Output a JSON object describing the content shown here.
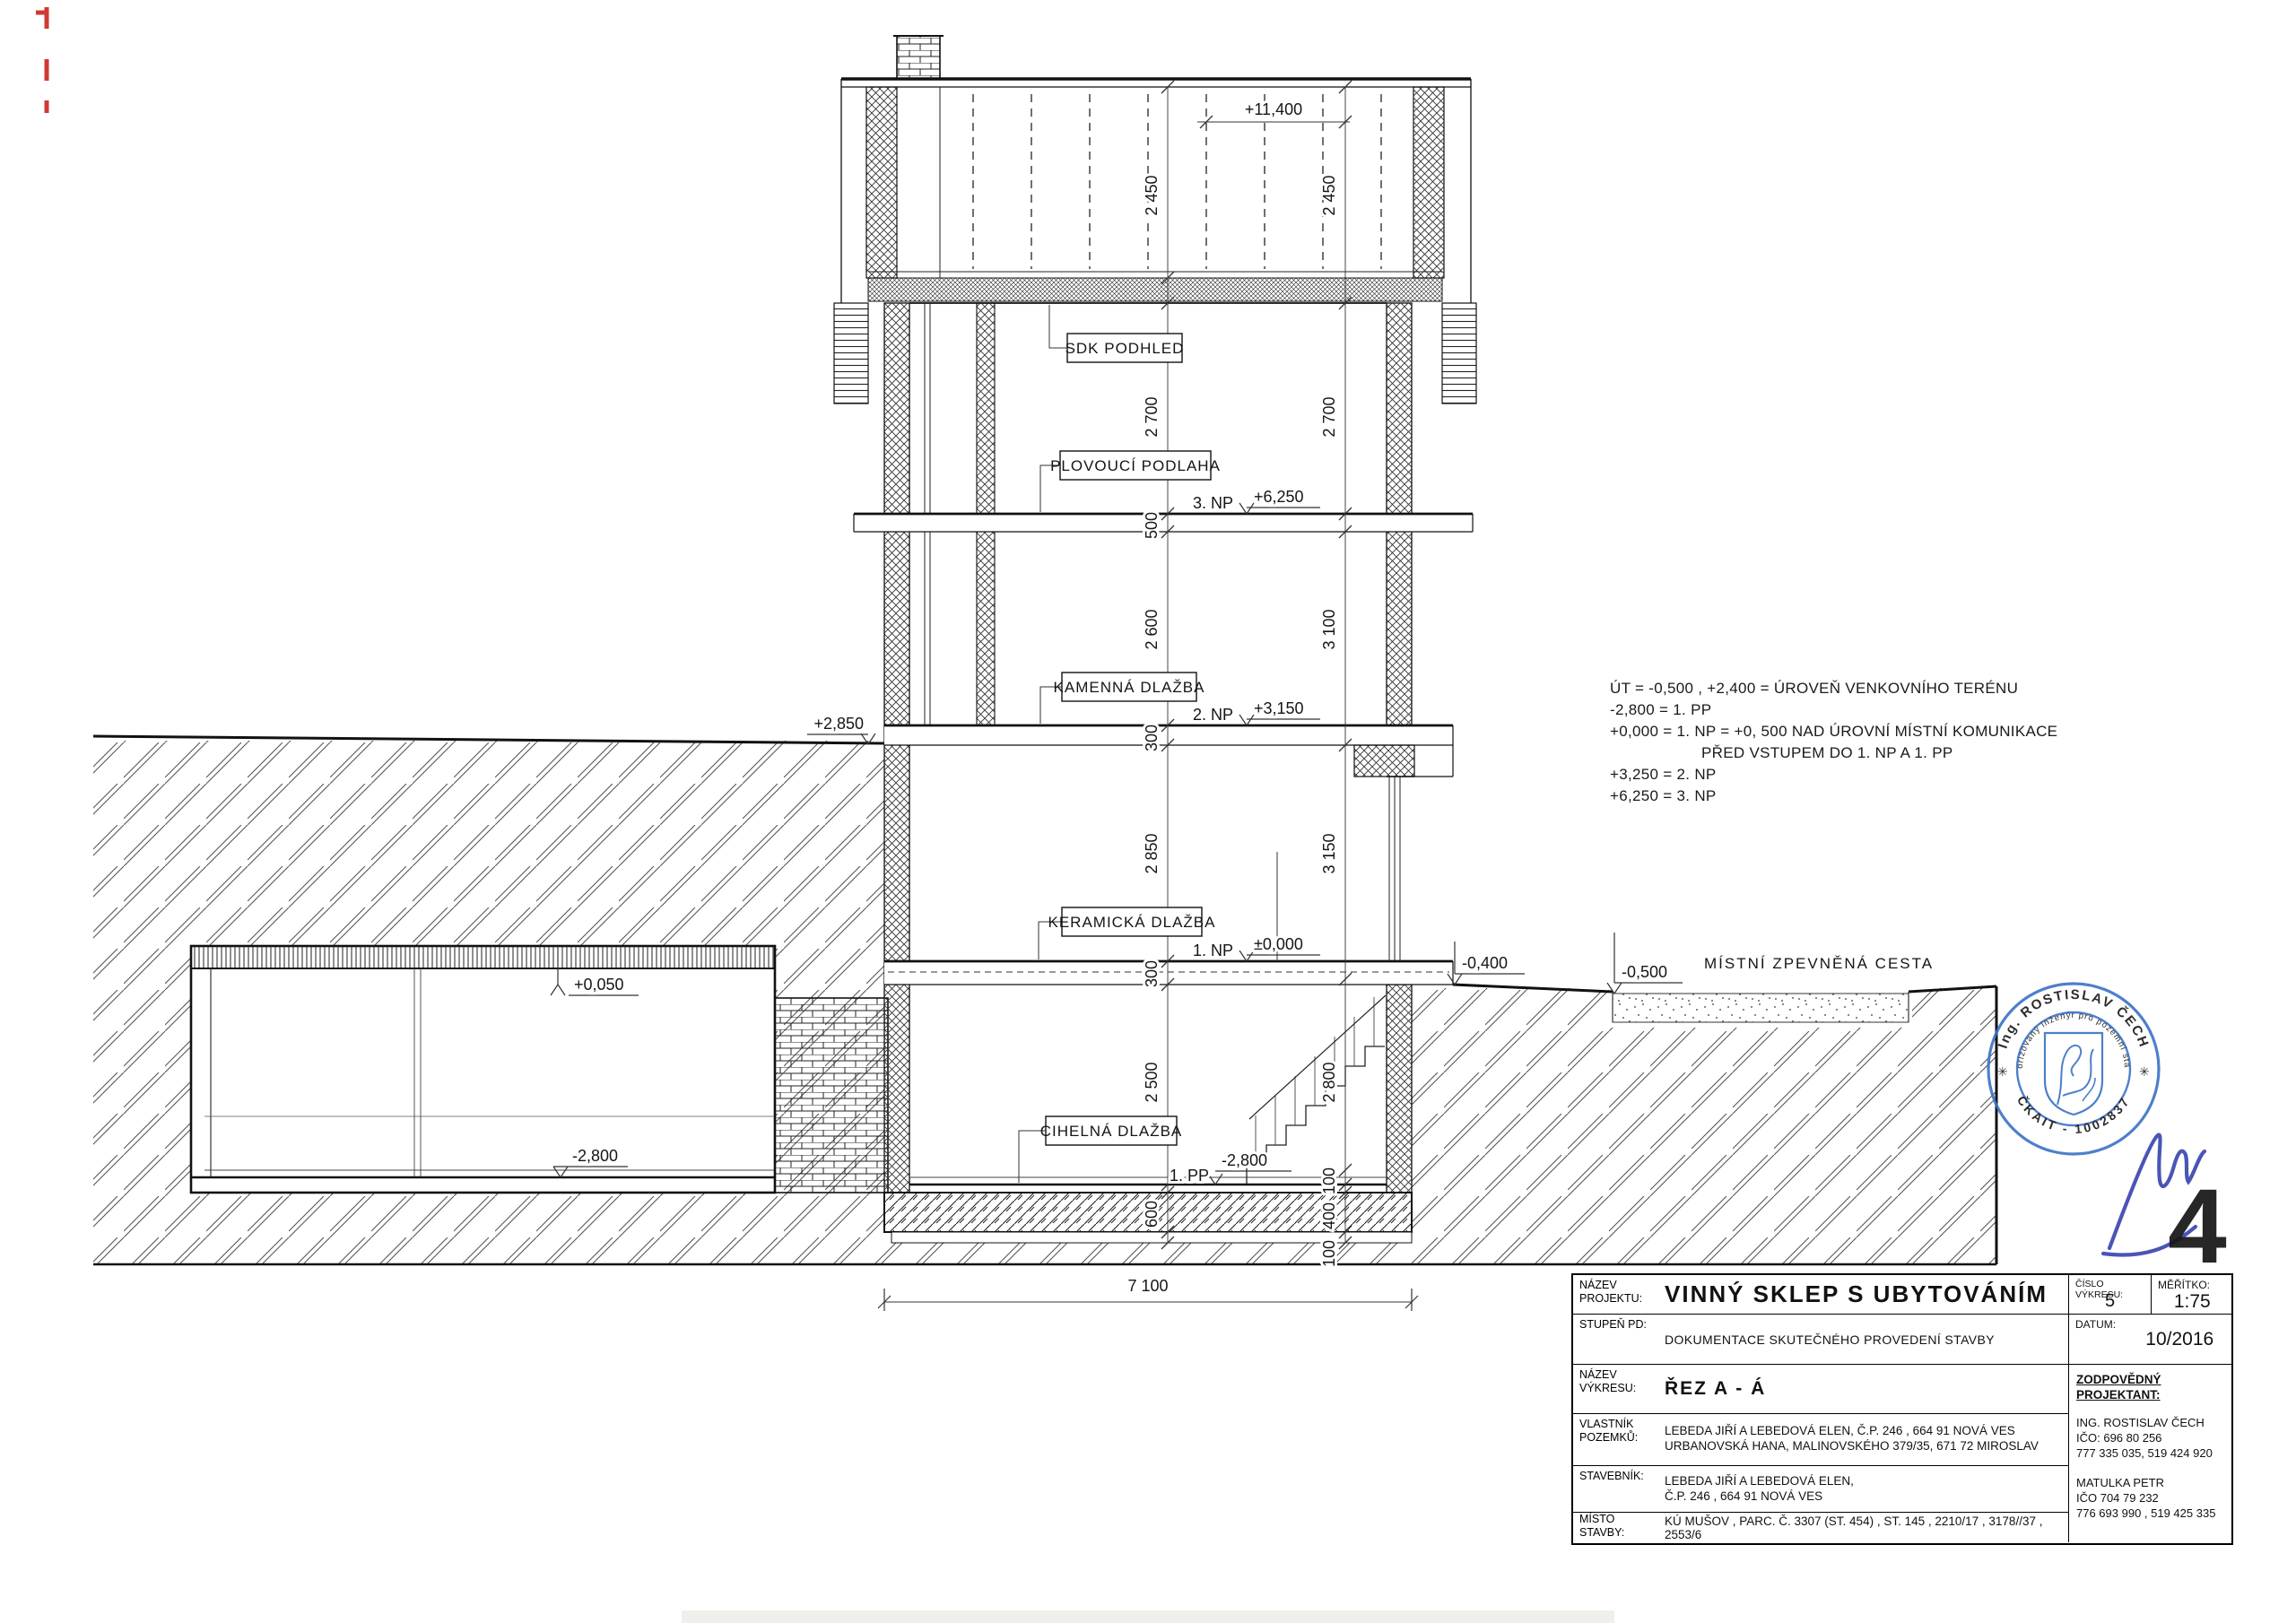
{
  "dims": {
    "top": "+11,400",
    "attic_left": "2 450",
    "attic_right": "2 450",
    "f3_left": "2 700",
    "f3_right": "2 700",
    "slab3": "500",
    "f2_left": "2 600",
    "f2_right": "3 100",
    "slab2": "300",
    "f1_left": "2 850",
    "f1_right": "3 150",
    "slab1": "300",
    "pp_left": "2 500",
    "pp_right": "2 800",
    "pp_floor": "100",
    "base": "600",
    "base_right": "400",
    "lean": "100",
    "width": "7 100"
  },
  "levels": {
    "np3": "+6,250",
    "np3_tag": "3. NP",
    "np2": "+3,150",
    "np2_tag": "2. NP",
    "np1": "±0,000",
    "np1_tag": "1. NP",
    "pp1": "-2,800",
    "pp1_tag": "1. PP",
    "terrain_left": "+2,850",
    "cellar_top": "+0,050",
    "cellar_floor": "-2,800",
    "ext_near": "-0,400",
    "ext_road": "-0,500"
  },
  "materials": {
    "ceiling3": "SDK PODHLED",
    "floor3": "PLOVOUCÍ PODLAHA",
    "floor2": "KAMENNÁ DLAŽBA",
    "floor1": "KERAMICKÁ DLAŽBA",
    "floor0": "CIHELNÁ DLAŽBA"
  },
  "road_label": "MÍSTNÍ ZPEVNĚNÁ CESTA",
  "legend": {
    "lines": [
      "ÚT  =  -0,500 ,  +2,400   =  ÚROVEŇ VENKOVNÍHO TERÉNU",
      "-2,800  =  1. PP",
      "+0,000 =  1. NP  =  +0, 500 NAD ÚROVNÍ MÍSTNÍ  KOMUNIKACE",
      "PŘED VSTUPEM DO  1. NP A  1. PP",
      "+3,250 =  2. NP",
      "+6,250 =  3. NP"
    ]
  },
  "titleblock": {
    "nazev_projektu_label": "NÁZEV PROJEKTU:",
    "project_title": "VINNÝ  SKLEP  S  UBYTOVÁNÍM",
    "cislo_vykresu_label": "ČÍSLO VÝKRESU:",
    "cislo_vykresu": "5",
    "meritko_label": "MĚŘÍTKO:",
    "meritko": "1:75",
    "stupen_label": "STUPEŇ PD:",
    "stupen": "DOKUMENTACE SKUTEČNÉHO  PROVEDENÍ  STAVBY",
    "datum_label": "DATUM:",
    "datum": "10/2016",
    "nazev_vykresu_label": "NÁZEV VÝKRESU:",
    "nazev_vykresu": "ŘEZ  A - Á",
    "zodpovedny_label": "ZODPOVĚDNÝ PROJEKTANT:",
    "projektant1_line1": "ING. ROSTISLAV ČECH",
    "projektant1_line2": "IČO: 696 80 256",
    "projektant1_line3": "777 335 035, 519 424 920",
    "projektant2_line1": "MATULKA  PETR",
    "projektant2_line2": "IČO 704 79 232",
    "projektant2_line3": "776 693 990 ,  519 425 335",
    "vlastnik_label": "VLASTNÍK POZEMKŮ:",
    "vlastnik_line1": "LEBEDA JIŘÍ A LEBEDOVÁ  ELEN, Č.P. 246 , 664 91  NOVÁ  VES",
    "vlastnik_line2": "URBANOVSKÁ  HANA, MALINOVSKÉHO 379/35, 671 72  MIROSLAV",
    "stavebnik_label": "STAVEBNÍK:",
    "stavebnik_line1": "LEBEDA JIŘÍ A LEBEDOVÁ  ELEN,",
    "stavebnik_line2": "Č.P. 246 , 664 91  NOVÁ  VES",
    "misto_label": "MÍSTO STAVBY:",
    "misto": "KÚ  MUŠOV , PARC. Č. 3307 (ST. 454) , ST. 145 , 2210/17 , 3178//37 , 2553/6"
  },
  "stamp": {
    "arc_top": "Ing. ROSTISLAV ČECH",
    "arc_mid": "Autorizovaný inženýr pro pozemní stavby",
    "arc_bottom": "ČKAIT - 1002837",
    "star": "✳",
    "number": "4"
  }
}
